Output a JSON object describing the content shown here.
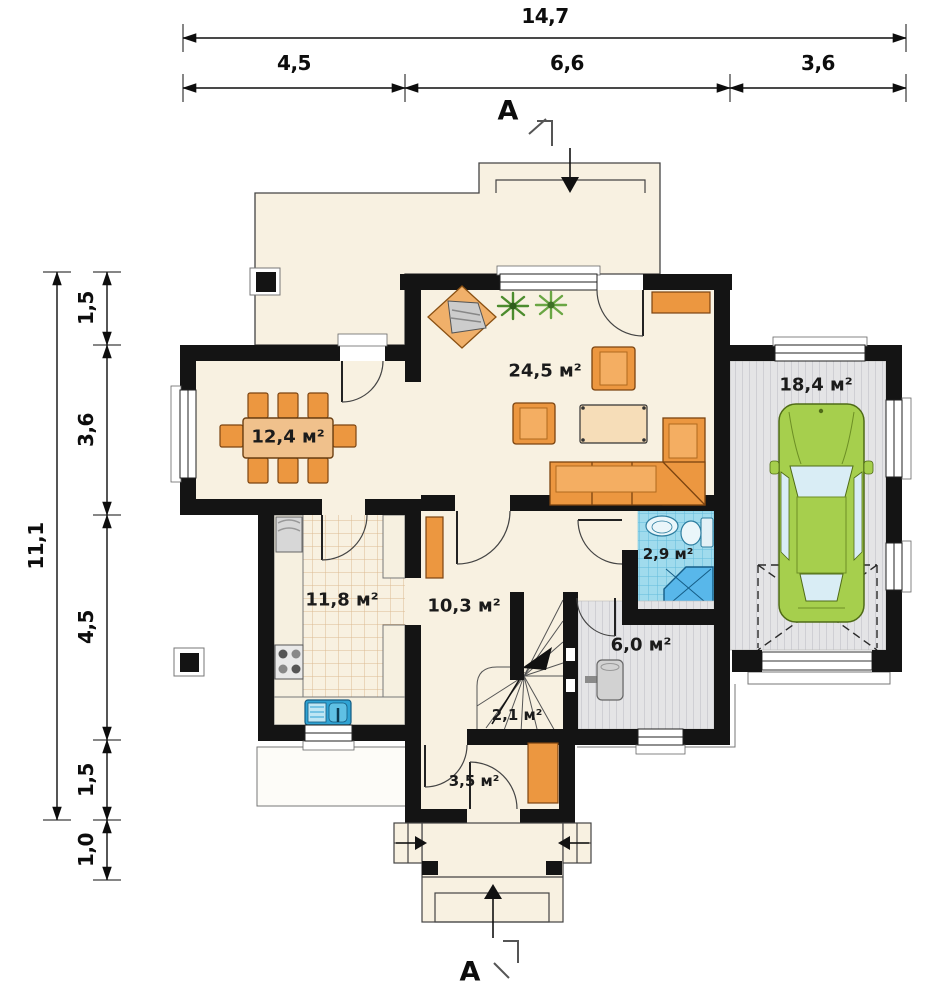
{
  "dimensions": {
    "top": {
      "total": "14,7",
      "segments": [
        "4,5",
        "6,6",
        "3,6"
      ]
    },
    "left": {
      "total": "11,1",
      "segments": [
        "1,5",
        "3,6",
        "4,5",
        "1,5",
        "1,0"
      ]
    }
  },
  "section": {
    "top_label": "A",
    "bottom_label": "A"
  },
  "rooms": [
    {
      "name": "living-room",
      "area_label": "24,5 м²"
    },
    {
      "name": "dining-room",
      "area_label": "12,4 м²"
    },
    {
      "name": "garage",
      "area_label": "18,4 м²"
    },
    {
      "name": "kitchen",
      "area_label": "11,8 м²"
    },
    {
      "name": "hall",
      "area_label": "10,3 м²"
    },
    {
      "name": "bathroom",
      "area_label": "2,9 м²"
    },
    {
      "name": "utility-room",
      "area_label": "6,0 м²"
    },
    {
      "name": "stairs",
      "area_label": "2,1 м²"
    },
    {
      "name": "entry",
      "area_label": "3,5 м²"
    }
  ],
  "colors": {
    "wall": "#141414",
    "floor_cream": "#f8f1e1",
    "furniture_orange": "#ec9740",
    "car_green": "#a6cf4d",
    "bath_tile": "#a0dbed",
    "gray_floor": "#e4e4e6",
    "shower_blue": "#58b7ea",
    "sink_blue": "#2fa3d4"
  }
}
